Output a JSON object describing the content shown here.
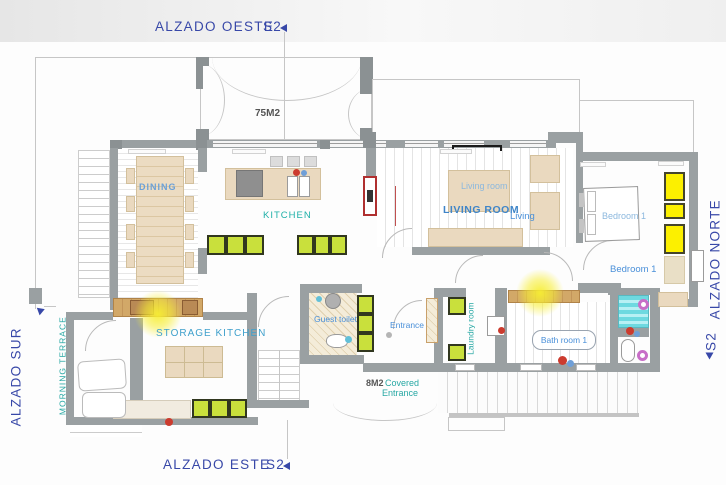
{
  "elevations": {
    "west": "ALZADO OESTE",
    "south": "ALZADO SUR",
    "east": "ALZADO ESTE",
    "north": "ALZADO NORTE"
  },
  "section_markers": {
    "west": "S2",
    "east": "S2",
    "north": "S2"
  },
  "areas": {
    "roof_terrace": "75M2",
    "covered_entrance": "8M2"
  },
  "rooms": {
    "dining": "DINING",
    "kitchen": "KITCHEN",
    "living_caption": "Living room",
    "living": "LIVING ROOM",
    "living_short": "Living",
    "bedroom_caption": "Bedroom 1",
    "bedroom": "Bedroom 1",
    "storage_kitchen": "STORAGE KITCHEN",
    "morning_terrace": "MORNING TERRACE",
    "guest_toilet": "Guest toilet",
    "entrance": "Entrance",
    "laundry": "Laundry room",
    "bathroom": "Bath room 1",
    "covered_entrance_line1": "Covered",
    "covered_entrance_line2": "Entrance"
  },
  "colors": {
    "wall": "#9aa0a2",
    "cabinet_green": "#c9e03c",
    "wardrobe_yellow": "#fcf000",
    "shower_cyan": "#6ed9e0",
    "furniture_tan": "#ead9bf",
    "light_glow": "#f7ee32",
    "elevation_label": "#3848a8",
    "room_label_blue": "#4a90d9",
    "room_label_teal": "#27a8a4"
  }
}
